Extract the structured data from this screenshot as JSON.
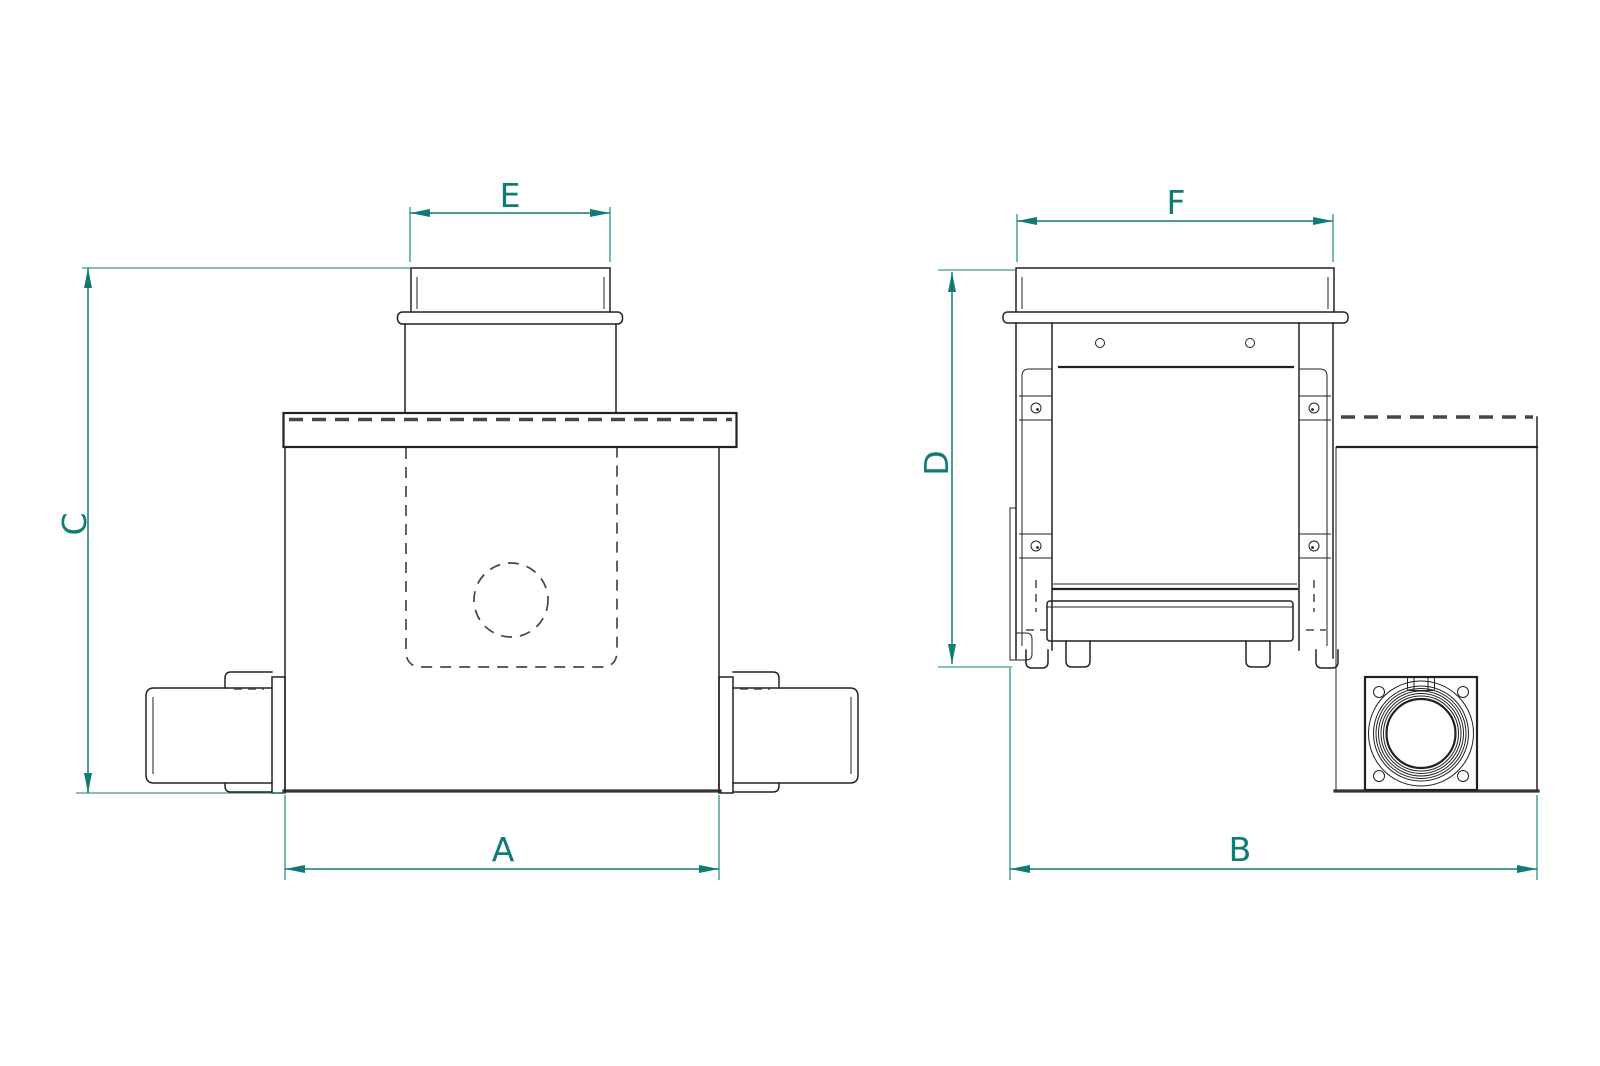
{
  "drawing": {
    "kind": "technical-dimension-drawing",
    "views": {
      "front_view": "front elevation of duct filter box",
      "side_view": "side elevation of duct filter box"
    }
  },
  "dimensions": {
    "labels": {
      "A": "A",
      "B": "B",
      "C": "C",
      "D": "D",
      "E": "E",
      "F": "F"
    }
  },
  "colors": {
    "dimension_accent": "#0e7c74",
    "line_color": "#222222",
    "heavy_line_color": "#333333",
    "dashed_line_color": "#474747",
    "background": "#ffffff"
  }
}
